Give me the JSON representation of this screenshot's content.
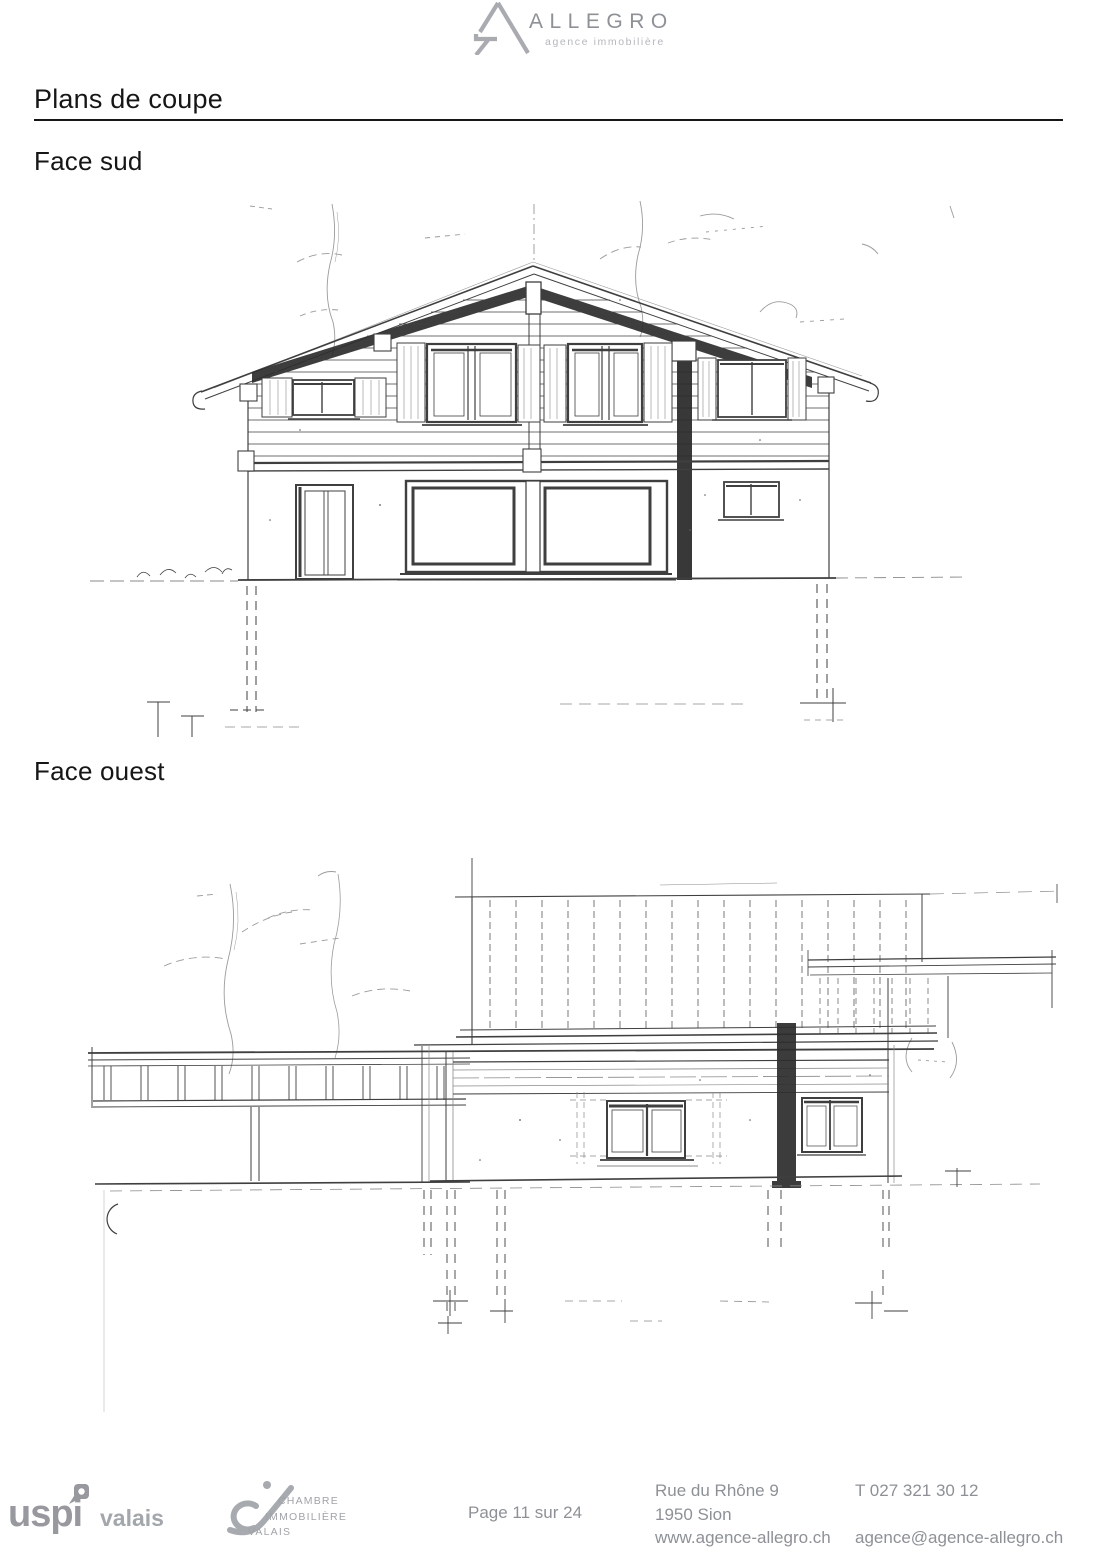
{
  "header": {
    "brand": "ALLEGRO",
    "tagline": "agence immobilière"
  },
  "content": {
    "title": "Plans de coupe",
    "sections": [
      {
        "label": "Face sud"
      },
      {
        "label": "Face ouest"
      }
    ]
  },
  "footer": {
    "uspi": {
      "name": "uspi",
      "region": "valais"
    },
    "chambre": {
      "lines": [
        "CHAMBRE",
        "IMMOBILIÈRE",
        "VALAIS"
      ]
    },
    "page_indicator": "Page 11 sur 24",
    "address": [
      "Rue du Rhône 9",
      "1950 Sion",
      "www.agence-allegro.ch"
    ],
    "contact": {
      "phone": "T 027 321 30 12",
      "email": "agence@agence-allegro.ch"
    }
  },
  "colors": {
    "ink": "#161616",
    "gray_text": "#8d9196",
    "logo_gray": "#a9abb0",
    "sketch": "#3f3f3f"
  }
}
